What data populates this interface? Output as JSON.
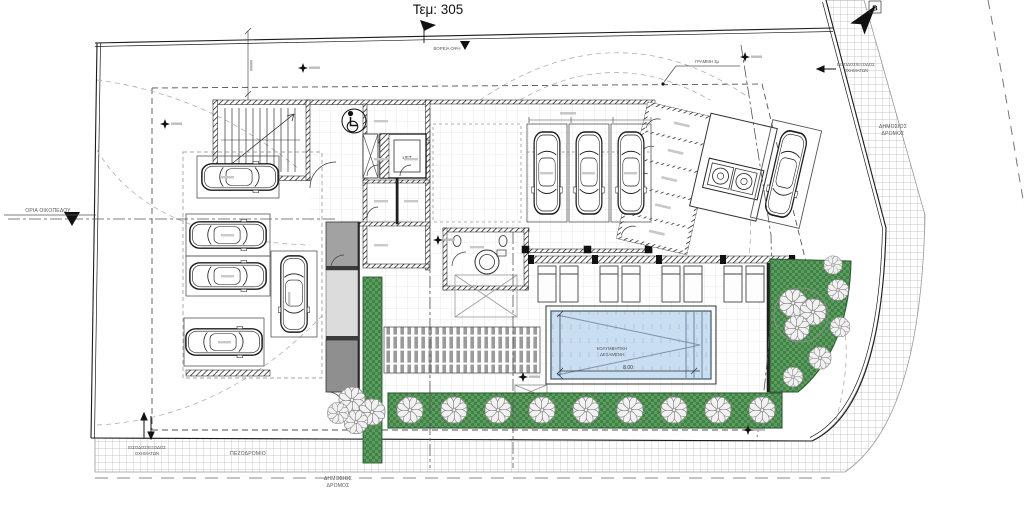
{
  "drawing": {
    "plot_label": "Τεμ: 305",
    "north_letter": "B"
  },
  "labels": {
    "north_elevation": "ΒΟΡΕΙΑ ΟΨΗ",
    "setback_line": "ΓΡΑΜΜΗ 3μ",
    "plot_boundary": "ΟΡΙΑ ΟΙΚΟΠΕΔΟΥ",
    "vehicle_entry_exit_line1": "ΕΙΣΟΔΟΣ/ΕΞΟΔΟΣ",
    "vehicle_entry_exit_line2": "ΟΧΗΜΑΤΩΝ",
    "public_road_line1": "ΔΗΜΟΣΙΟΣ",
    "public_road_line2": "ΔΡΟΜΟΣ",
    "sidewalk": "ΠΕΖΟΔΡΟΜΙΟ",
    "lift": "LIFT",
    "pool_line1": "ΚΟΛΥΜΒΗΤΙΚΗ",
    "pool_line2": "ΔΕΞΑΜΕΝΗ",
    "pool_length_dim": "8.00"
  },
  "colors": {
    "line": "#1c1c1c",
    "landscape_green": "#57a05b",
    "landscape_green_dark": "#477f4b",
    "pool_water": "#c9def1",
    "ramp_gray": "#a2a2a2",
    "sidewalk_line": "#b8b8b8"
  }
}
